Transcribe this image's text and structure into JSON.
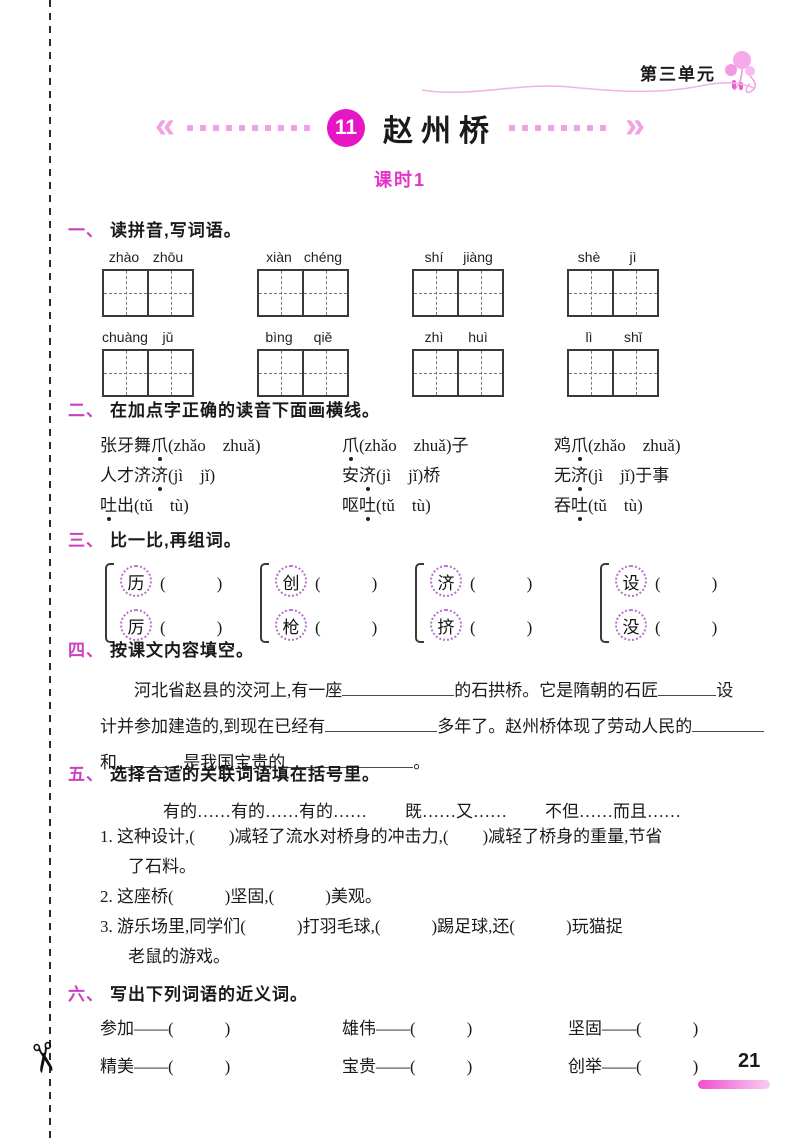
{
  "header": {
    "unit_label": "第三单元"
  },
  "title": {
    "lesson_number": "11",
    "lesson_name": "赵州桥",
    "session_label": "课时1"
  },
  "footer": {
    "page_number": "21"
  },
  "s1": {
    "num": "一、",
    "heading": "读拼音,写词语。",
    "words": [
      {
        "p1": "zhào",
        "p2": "zhōu"
      },
      {
        "p1": "xiàn",
        "p2": "chéng"
      },
      {
        "p1": "shí",
        "p2": "jiàng"
      },
      {
        "p1": "shè",
        "p2": "jì"
      },
      {
        "p1": "chuàng",
        "p2": "jǔ"
      },
      {
        "p1": "bìng",
        "p2": "qiě"
      },
      {
        "p1": "zhì",
        "p2": "huì"
      },
      {
        "p1": "lì",
        "p2": "shǐ"
      }
    ]
  },
  "s2": {
    "num": "二、",
    "heading": "在加点字正确的读音下面画横线。",
    "items": [
      {
        "pre": "张牙舞",
        "dot": "爪",
        "post": "(zhǎo　zhuǎ)"
      },
      {
        "pre": "",
        "dot": "爪",
        "post": "(zhǎo　zhuǎ)子"
      },
      {
        "pre": "鸡",
        "dot": "爪",
        "post": "(zhǎo　zhuǎ)"
      },
      {
        "pre": "人才济",
        "dot": "济",
        "post": "(jì　jǐ)"
      },
      {
        "pre": "安",
        "dot": "济",
        "post": "(jì　jǐ)桥"
      },
      {
        "pre": "无",
        "dot": "济",
        "post": "(jì　jǐ)于事"
      },
      {
        "pre": "",
        "dot": "吐",
        "post": "出(tǔ　tù)"
      },
      {
        "pre": "呕",
        "dot": "吐",
        "post": "(tǔ　tù)"
      },
      {
        "pre": "吞",
        "dot": "吐",
        "post": "(tǔ　tù)"
      }
    ]
  },
  "s3": {
    "num": "三、",
    "heading": "比一比,再组词。",
    "paren": "(　　　)",
    "pairs": [
      {
        "top": "历",
        "bottom": "厉"
      },
      {
        "top": "创",
        "bottom": "枪"
      },
      {
        "top": "济",
        "bottom": "挤"
      },
      {
        "top": "设",
        "bottom": "没"
      }
    ]
  },
  "s4": {
    "num": "四、",
    "heading": "按课文内容填空。",
    "line1": {
      "t1": "河北省赵县的洨河上,有一座",
      "t2": "的石拱桥。它是隋朝的石匠",
      "t3": "设"
    },
    "line2": {
      "t1": "计并参加建造的,到现在已经有",
      "t2": "多年了。赵州桥体现了劳动人民的"
    },
    "line3": {
      "t1": "和",
      "t2": ",是我国宝贵的",
      "t3": "。"
    }
  },
  "s5": {
    "num": "五、",
    "heading": "选择合适的关联词语填在括号里。",
    "options": [
      "有的……有的……有的……",
      "既……又……",
      "不但……而且……"
    ],
    "item1_line1": "1. 这种设计,(　　)减轻了流水对桥身的冲击力,(　　)减轻了桥身的重量,节省",
    "item1_line2": "了石料。",
    "item2": "2. 这座桥(　　　)坚固,(　　　)美观。",
    "item3_line1": "3. 游乐场里,同学们(　　　)打羽毛球,(　　　)踢足球,还(　　　)玩猫捉",
    "item3_line2": "老鼠的游戏。"
  },
  "s6": {
    "num": "六、",
    "heading": "写出下列词语的近义词。",
    "items": [
      "参加——(　　　)",
      "雄伟——(　　　)",
      "坚固——(　　　)",
      "精美——(　　　)",
      "宝贵——(　　　)",
      "创举——(　　　)"
    ]
  }
}
